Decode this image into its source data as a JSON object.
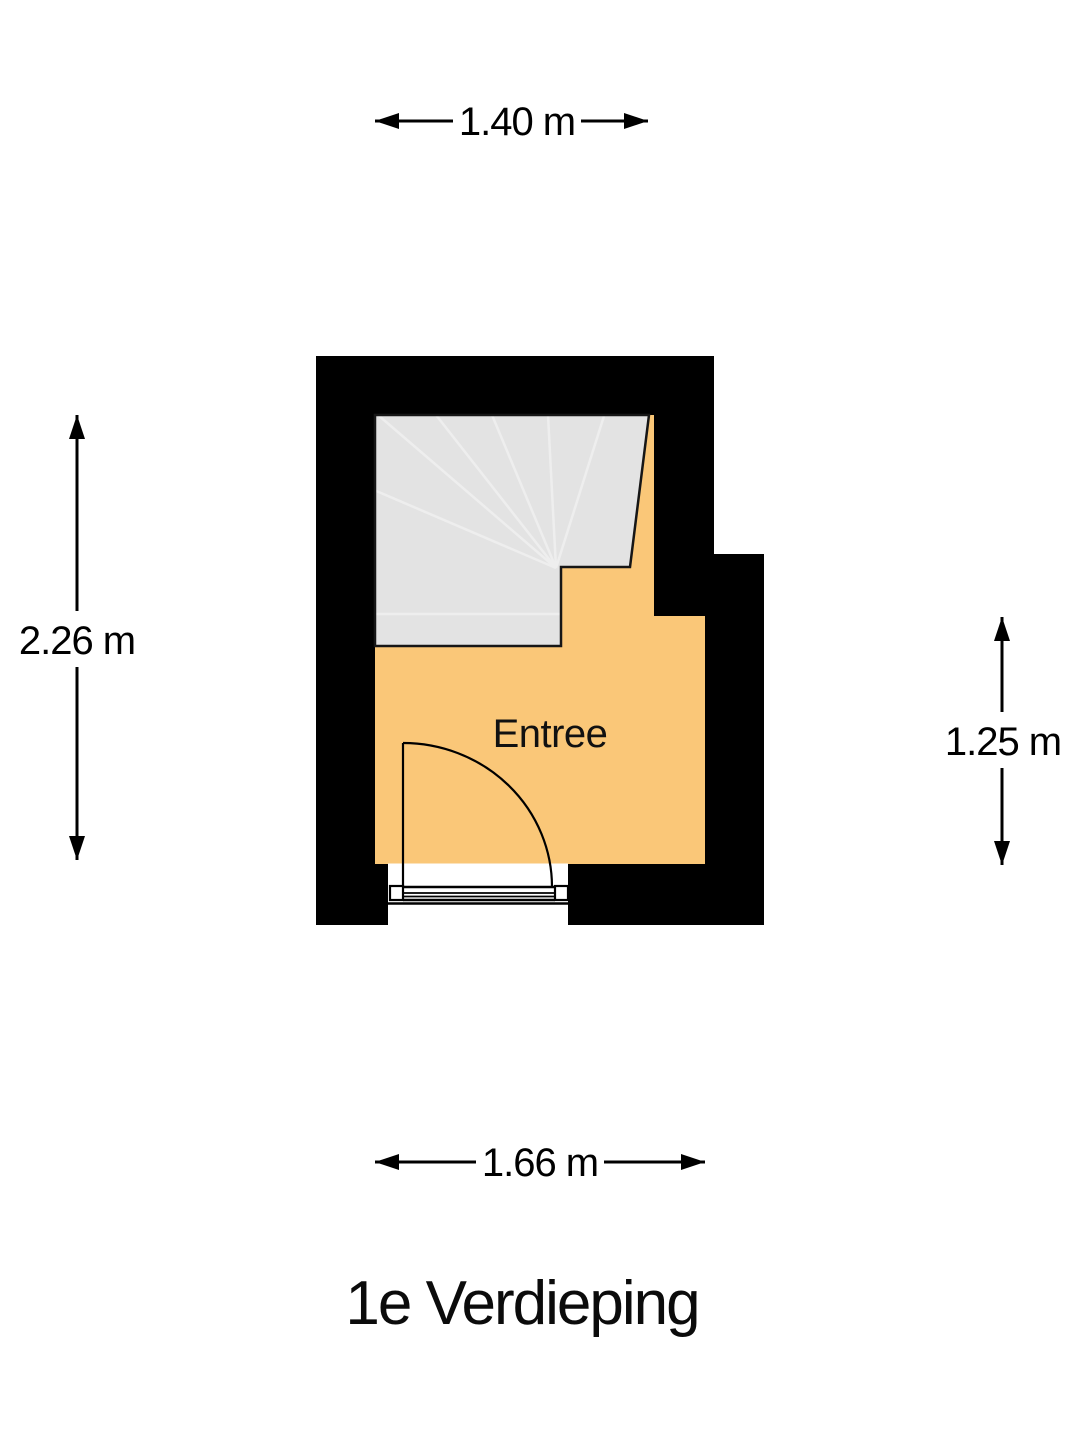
{
  "title": "1e Verdieping",
  "room": {
    "label": "Entree"
  },
  "dimensions": {
    "top": "1.40 m",
    "left": "2.26 m",
    "right": "1.25 m",
    "bottom": "1.66 m"
  },
  "colors": {
    "background": "#ffffff",
    "wall": "#000000",
    "floor": "#fac778",
    "stairs_fill": "#e3e3e3",
    "stairs_tread_line": "#eeeeee",
    "outline": "#161616",
    "line": "#000000"
  }
}
